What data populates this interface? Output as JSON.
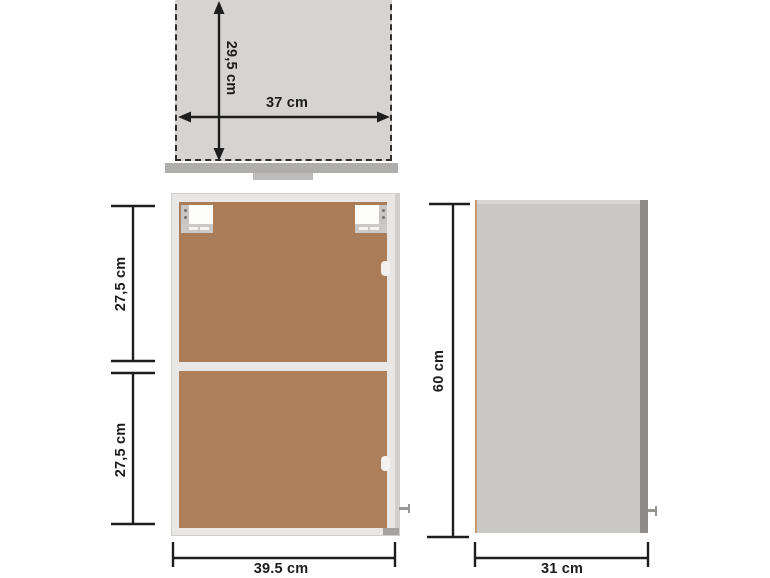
{
  "page": {
    "description": "Wall cabinet dimension diagram with top view, front view and side view"
  },
  "colors": {
    "line": "#1e1e1e",
    "text": "#1c1c1c",
    "top_fill": "#d5d4d2",
    "bar_gray": "#b0aeac",
    "tab_gray": "#bebcba",
    "frame_light": "#e8e7e5",
    "frame_edge": "#cfcecc",
    "wood_brown": "#aa7c57",
    "bracket_gray": "#c8c6c4",
    "side_gray": "#c9c8c6",
    "side_edge_dark": "#8d8c8a",
    "side_edge_tan": "#c89a6a",
    "handle_gray": "#9a9896"
  },
  "views": {
    "top_view": {
      "depth_label": "29,5 cm",
      "width_label": "37 cm"
    },
    "front_view": {
      "upper_compartment_label": "27,5 cm",
      "lower_compartment_label": "27,5 cm",
      "width_label": "39.5 cm"
    },
    "side_view": {
      "height_label": "60 cm",
      "depth_label": "31 cm"
    }
  }
}
